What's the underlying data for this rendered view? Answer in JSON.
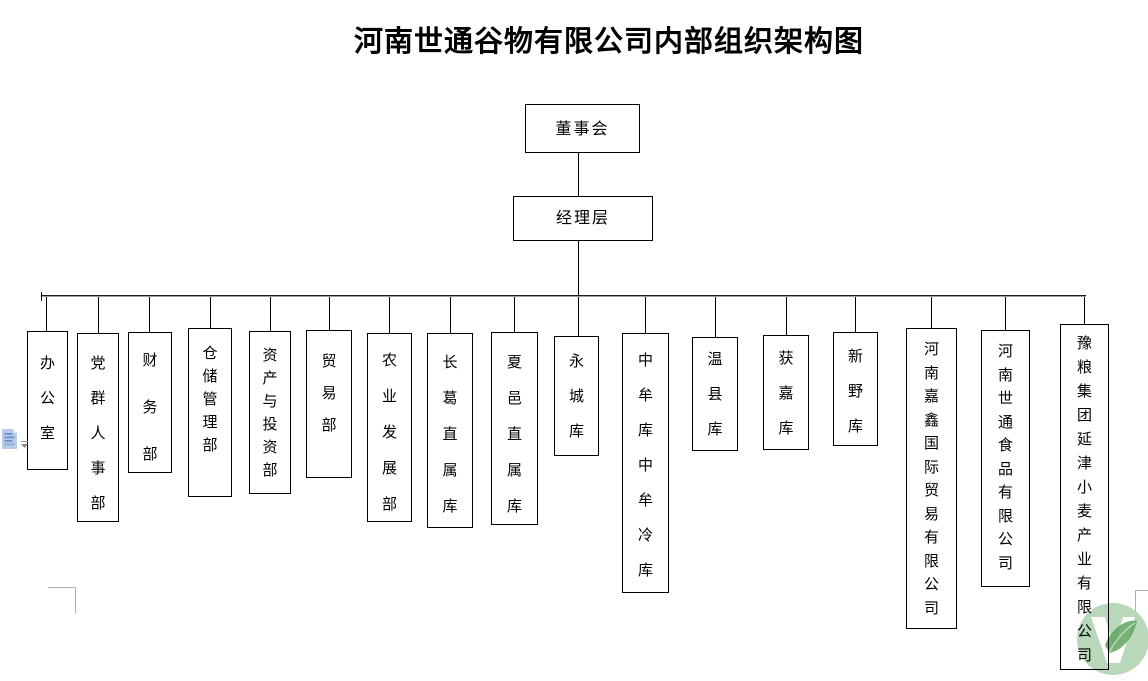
{
  "page": {
    "title": "河南世通谷物有限公司内部组织架构图"
  },
  "diagram": {
    "type": "org-chart",
    "root": {
      "label": "董事会"
    },
    "level2": {
      "label": "经理层"
    },
    "departments": [
      {
        "label": "办公室"
      },
      {
        "label": "党群人事部"
      },
      {
        "label": "财务部"
      },
      {
        "label": "仓储管理部"
      },
      {
        "label": "资产与投资部"
      },
      {
        "label": "贸易部"
      },
      {
        "label": "农业发展部"
      },
      {
        "label": "长葛直属库"
      },
      {
        "label": "夏邑直属库"
      },
      {
        "label": "永城库"
      },
      {
        "label": "中牟库中牟冷库"
      },
      {
        "label": "温县库"
      },
      {
        "label": "获嘉库"
      },
      {
        "label": "新野库"
      },
      {
        "label": "河南嘉鑫国际贸易有限公司"
      },
      {
        "label": "河南世通食品有限公司"
      },
      {
        "label": "豫粮集团延津小麦产业有限公司"
      }
    ]
  },
  "icons": {
    "paste_options": "document-paste-options-icon",
    "dropdown_arrow": "dropdown-arrow-icon",
    "watermark": "green-v-logo-watermark"
  },
  "colors": {
    "line": "#000000",
    "line_shadow": "#9e9e9e",
    "watermark_green": "#b9d8b9",
    "watermark_dark_green": "#5ea35e",
    "icon_blue": "#b9c9e8",
    "icon_stripe_blue": "#6e93cc",
    "boundary_mark_gray": "#b0b0b0"
  }
}
